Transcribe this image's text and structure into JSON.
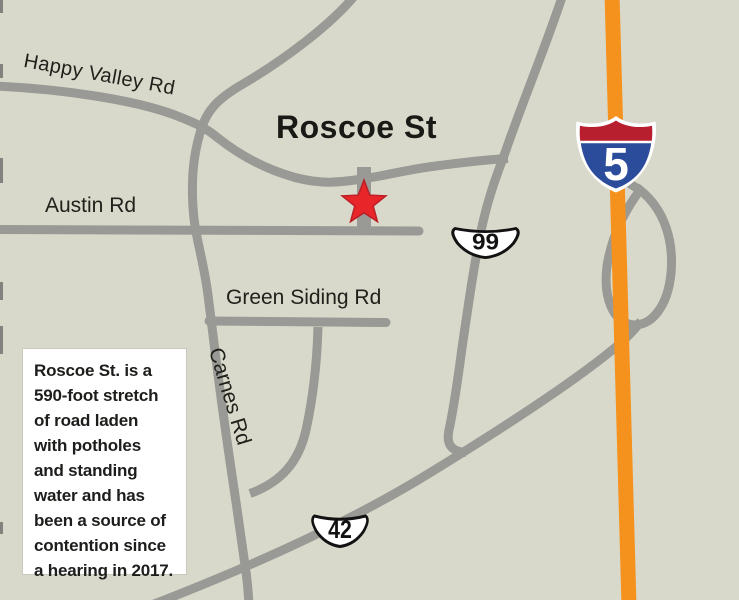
{
  "map": {
    "colors": {
      "background": "#d9d9cb",
      "road_gray": "#999995",
      "interstate_orange": "#f5921e",
      "star_red": "#e8262a",
      "interstate_shield_red": "#b71f2e",
      "interstate_shield_blue": "#2a4c9b",
      "route_shield_fill": "#ffffff",
      "route_shield_border": "#121212"
    },
    "labels": {
      "happy_valley": "Happy Valley Rd",
      "austin": "Austin Rd",
      "roscoe": "Roscoe St",
      "green_siding": "Green Siding Rd",
      "carnes": "Carnes Rd"
    },
    "shields": {
      "interstate": {
        "number": "5"
      },
      "route_99": {
        "number": "99"
      },
      "route_42": {
        "number": "42"
      }
    },
    "marker": {
      "type": "red-star",
      "location_label": "Roscoe St"
    },
    "caption": {
      "lines": [
        "Roscoe St. is a",
        "590-foot stretch",
        "of road laden",
        "with potholes",
        "and standing",
        "water and has",
        "been a source of",
        "contention since",
        "a hearing in 2017."
      ]
    }
  }
}
